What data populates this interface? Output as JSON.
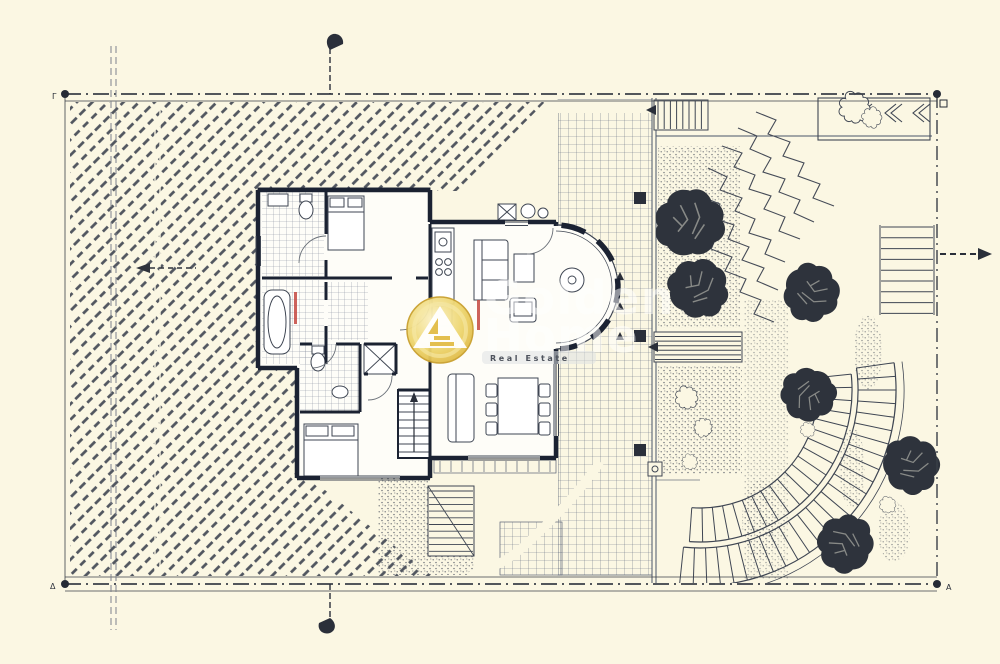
{
  "corners": {
    "top_left": "Γ",
    "bottom_left": "Δ",
    "bottom_right": "A"
  },
  "watermark": {
    "brand_top": "Golden",
    "brand_bottom": "Home",
    "tagline": "Real Estate"
  },
  "colors": {
    "paper": "#FBF7E3",
    "ink": "#3E4450",
    "wall": "#1B2232",
    "gold": "#E2BE4E",
    "red_accent": "#C4473F"
  }
}
